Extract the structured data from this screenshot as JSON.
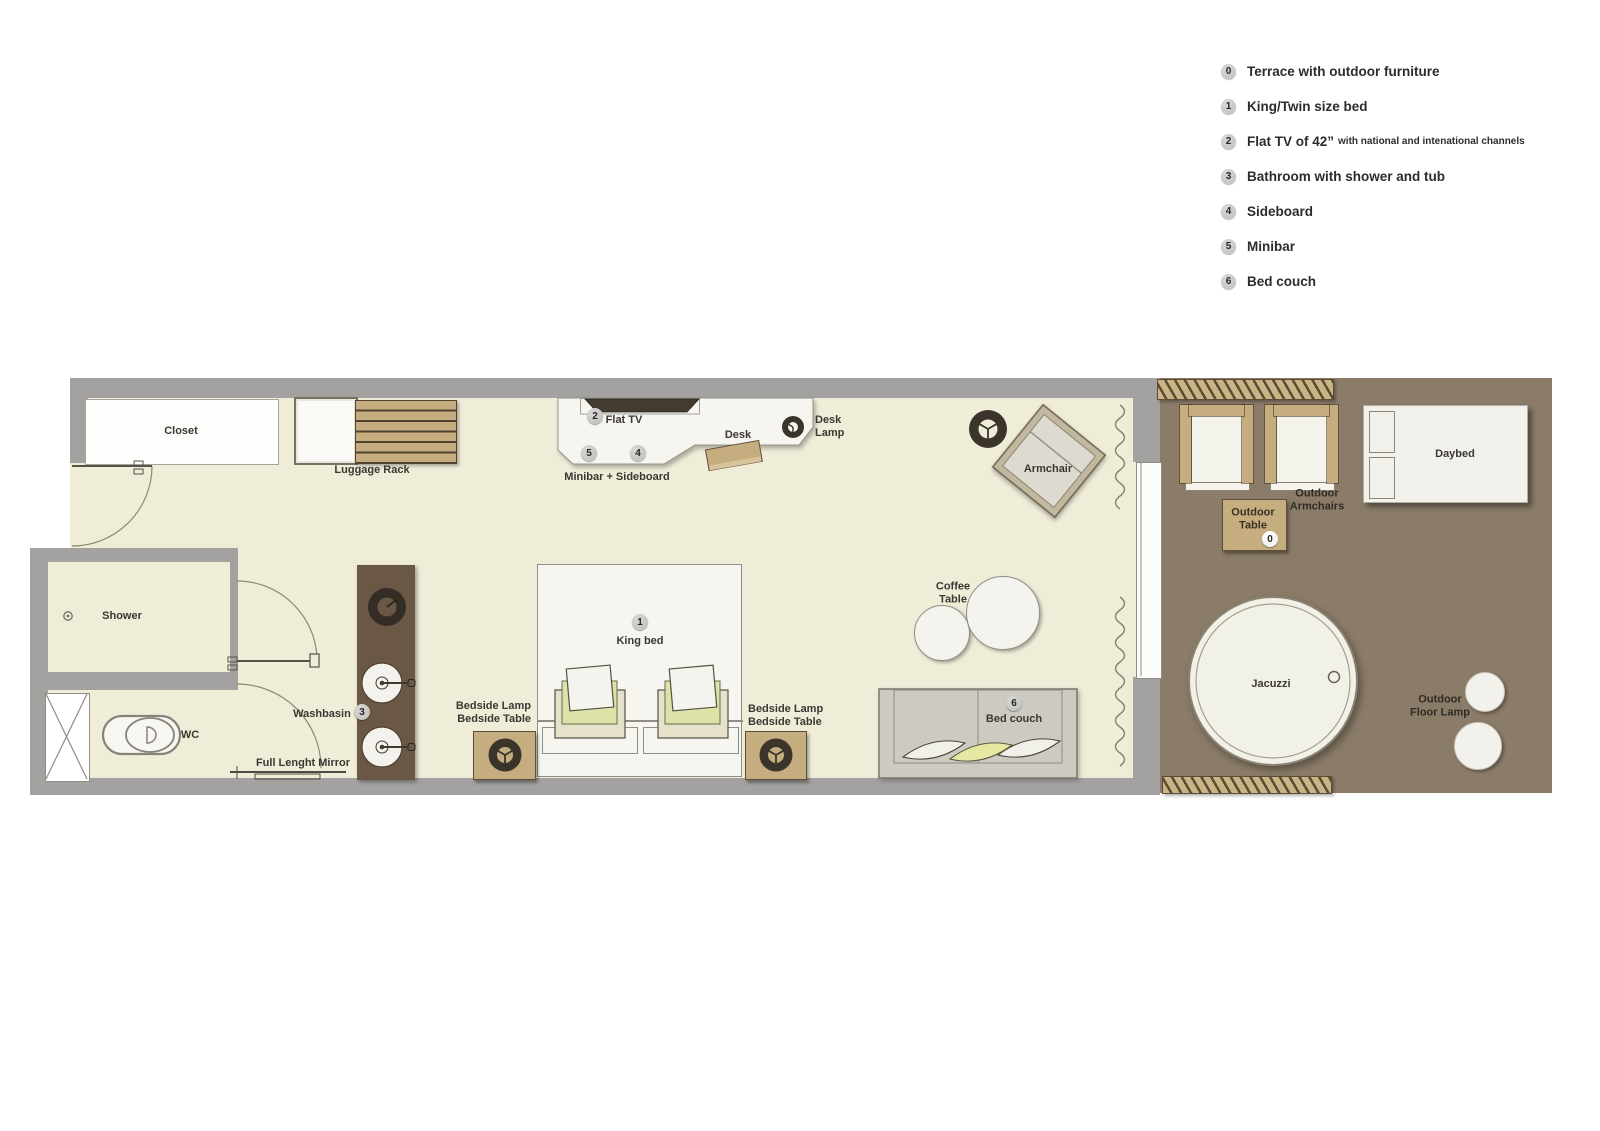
{
  "legend": {
    "items": [
      {
        "num": "0",
        "label": "Terrace with outdoor furniture",
        "sublabel": ""
      },
      {
        "num": "1",
        "label": "King/Twin size bed",
        "sublabel": ""
      },
      {
        "num": "2",
        "label": "Flat TV of 42”",
        "sublabel": "with national and intenational channels"
      },
      {
        "num": "3",
        "label": "Bathroom with shower and tub",
        "sublabel": ""
      },
      {
        "num": "4",
        "label": "Sideboard",
        "sublabel": ""
      },
      {
        "num": "5",
        "label": "Minibar",
        "sublabel": ""
      },
      {
        "num": "6",
        "label": "Bed couch",
        "sublabel": ""
      }
    ]
  },
  "plan": {
    "rooms": {
      "closet": "Closet",
      "shower": "Shower",
      "wc": "WC",
      "jacuzzi": "Jacuzzi",
      "daybed": "Daybed"
    },
    "furniture": {
      "luggage_rack": "Luggage Rack",
      "flat_tv": "Flat TV",
      "desk": "Desk",
      "desk_lamp_line1": "Desk",
      "desk_lamp_line2": "Lamp",
      "minibar_sideboard": "Minibar + Sideboard",
      "armchair": "Armchair",
      "washbasin": "Washbasin",
      "full_length_mirror": "Full Lenght Mirror",
      "bedside_lamp": "Bedside Lamp",
      "bedside_table": "Bedside Table",
      "king_bed": "King bed",
      "coffee_table_line1": "Coffee",
      "coffee_table_line2": "Table",
      "bed_couch": "Bed couch",
      "outdoor_armchairs_line1": "Outdoor",
      "outdoor_armchairs_line2": "Armchairs",
      "outdoor_table_line1": "Outdoor",
      "outdoor_table_line2": "Table",
      "outdoor_floor_lamp_line1": "Outdoor",
      "outdoor_floor_lamp_line2": "Floor Lamp"
    },
    "badges": {
      "flat_tv": "2",
      "minibar": "5",
      "sideboard": "4",
      "bathroom": "3",
      "king_bed": "1",
      "bed_couch": "6",
      "terrace": "0"
    }
  },
  "colors": {
    "floor": "#efecd8",
    "wall": "#a3a2a0",
    "terrace": "#8b7c69",
    "wood": "#c5ad80",
    "wood-dark": "#6a5845",
    "white-furniture": "#f6f5f0",
    "outline": "#8f8d85",
    "text": "#3b3833",
    "accent-yellow": "#e6e7a3"
  }
}
